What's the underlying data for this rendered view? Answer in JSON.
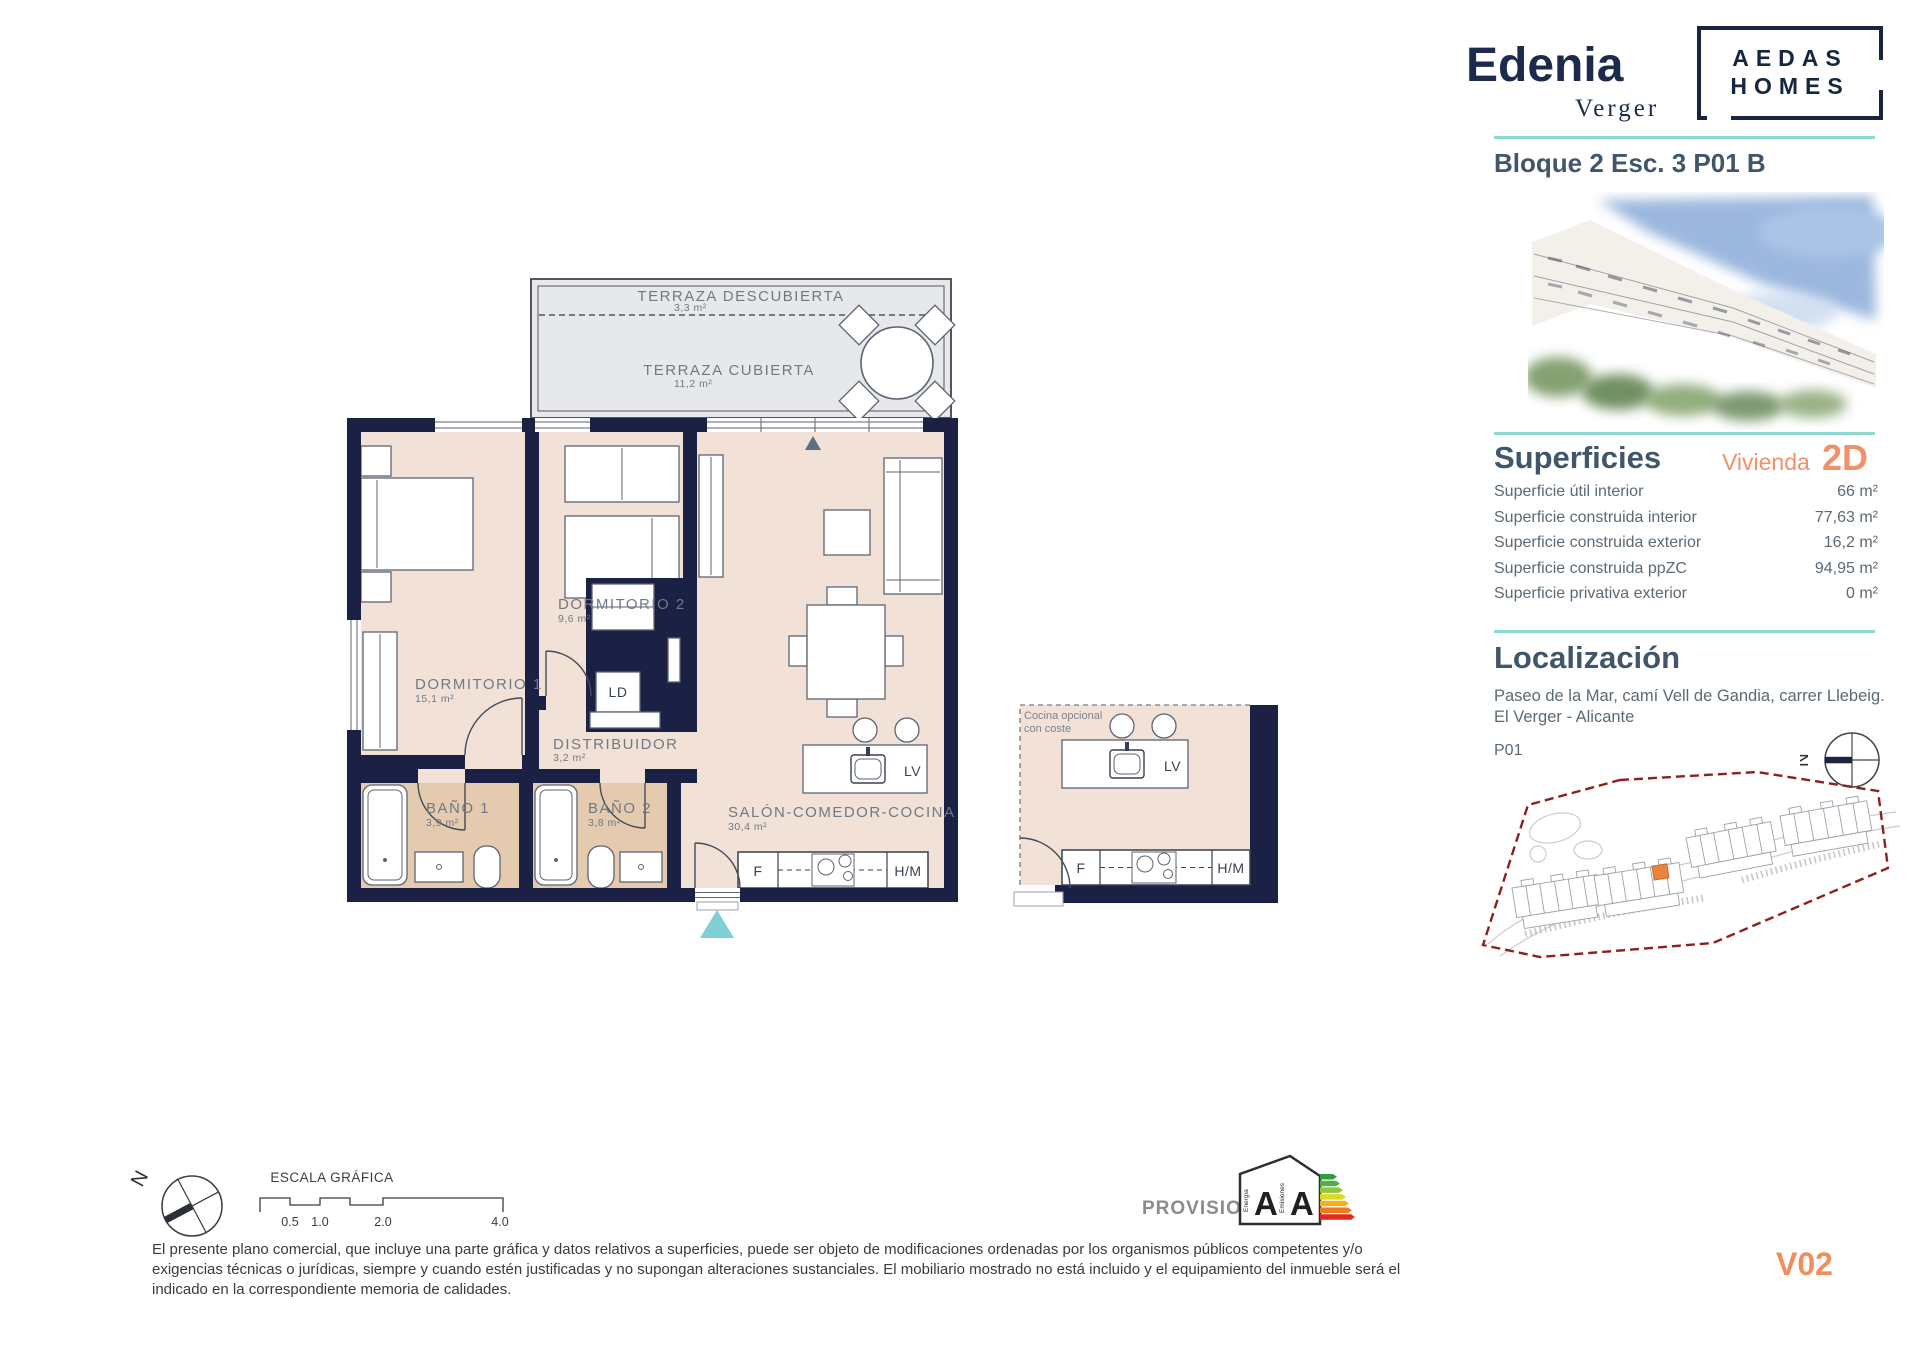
{
  "brand": {
    "name": "Edenia",
    "subname": "Verger",
    "partner_line1": "AEDAS",
    "partner_line2": "HOMES"
  },
  "header": {
    "unit_title": "Bloque 2 Esc. 3 P01 B"
  },
  "superficies": {
    "title": "Superficies",
    "vivienda_label": "Vivienda",
    "vivienda_code": "2D",
    "rows": [
      {
        "label": "Superficie útil interior",
        "value": "66 m²"
      },
      {
        "label": "Superficie construida interior",
        "value": "77,63 m²"
      },
      {
        "label": "Superficie construida exterior",
        "value": "16,2 m²"
      },
      {
        "label": "Superficie construida ppZC",
        "value": "94,95 m²"
      },
      {
        "label": "Superficie privativa exterior",
        "value": "0 m²"
      }
    ]
  },
  "localizacion": {
    "title": "Localización",
    "address": "Paseo de la Mar, camí Vell de Gandia, carrer Llebeig. El Verger - Alicante",
    "floor_label": "P01",
    "compass_n": "N"
  },
  "plan": {
    "rooms": {
      "terraza_descubierta": {
        "name": "TERRAZA DESCUBIERTA",
        "area": "3,3 m²"
      },
      "terraza_cubierta": {
        "name": "TERRAZA CUBIERTA",
        "area": "11,2 m²"
      },
      "dormitorio_1": {
        "name": "DORMITORIO 1",
        "area": "15,1 m²"
      },
      "dormitorio_2": {
        "name": "DORMITORIO 2",
        "area": "9,6 m²"
      },
      "distribuidor": {
        "name": "DISTRIBUIDOR",
        "area": "3,2 m²"
      },
      "bano_1": {
        "name": "BAÑO 1",
        "area": "3,9 m²"
      },
      "bano_2": {
        "name": "BAÑO 2",
        "area": "3,8 m²"
      },
      "salon": {
        "name": "SALÓN-COMEDOR-COCINA",
        "area": "30,4 m²"
      }
    },
    "equipment": {
      "laundry": "LD",
      "dishwasher": "LV",
      "fridge": "F",
      "oven_micro": "H/M"
    },
    "optional_kitchen": {
      "note_line1": "Cocina opcional",
      "note_line2": "con coste"
    }
  },
  "footer": {
    "scale_title": "ESCALA GRÁFICA",
    "scale_ticks": [
      "0.5",
      "1.0",
      "2.0",
      "4.0"
    ],
    "provisional_label": "PROVISIONAL",
    "energy_rating": {
      "letter_energy": "A",
      "letter_emissions": "A",
      "label_energy": "Energía",
      "label_emissions": "Emisiones"
    },
    "disclaimer": "El presente plano comercial, que incluye una parte gráfica y datos relativos a superficies, puede ser objeto de modificaciones ordenadas por los organismos públicos competentes y/o exigencias técnicas o jurídicas, siempre y cuando estén justificadas y no supongan alteraciones sustanciales. El mobiliario mostrado no está incluido y el equipamiento del inmueble será el indicado en la correspondiente memoria de calidades.",
    "version": "V02",
    "compass_n": "N"
  },
  "colors": {
    "navy": "#1a2145",
    "teal": "#8fd8d2",
    "orange": "#f0916a",
    "slate": "#41566b",
    "room_fill": "#f2e1d6",
    "bath_fill": "#e4caaf",
    "terrace_fill": "#e7e8ea",
    "map_red": "#8c2020"
  }
}
